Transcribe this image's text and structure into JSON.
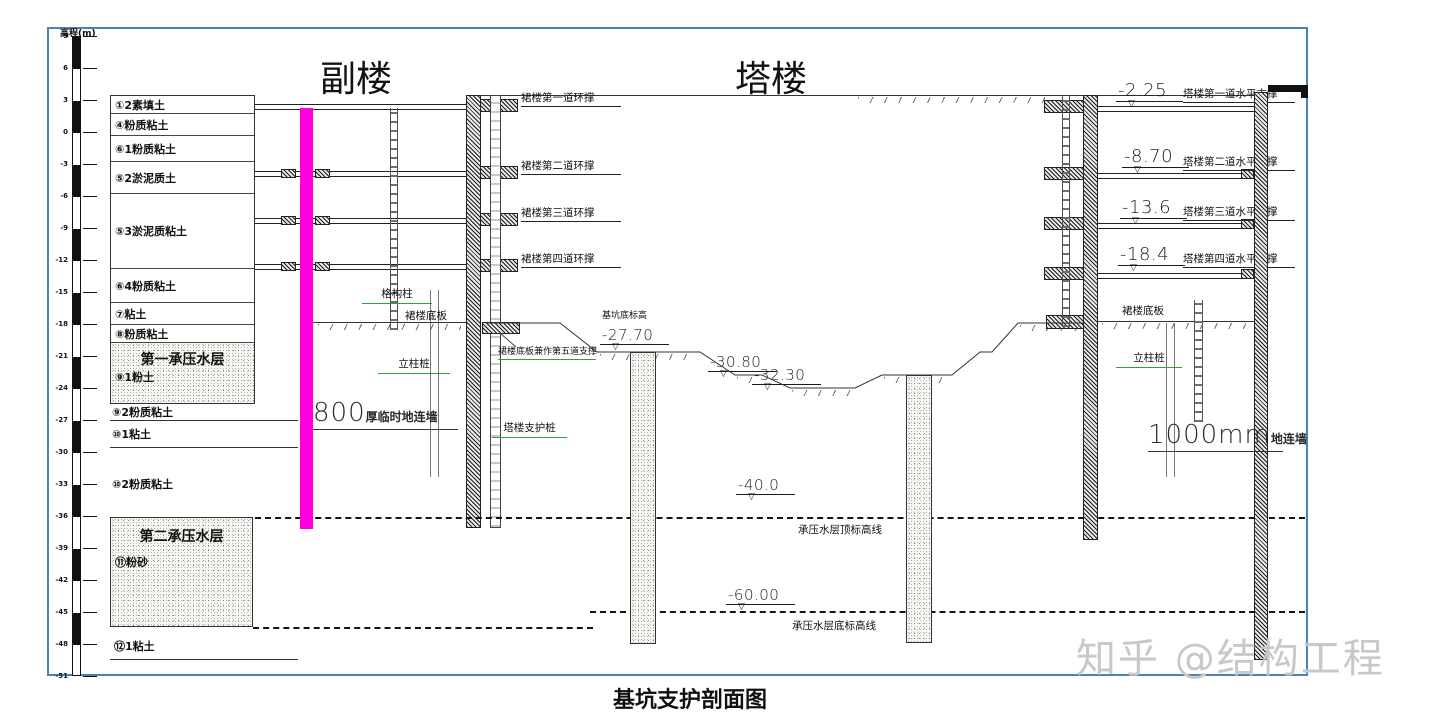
{
  "meta": {
    "title": "基坑支护剖面图",
    "watermark": "知乎 @结构工程"
  },
  "axis": {
    "label": "高程(m)",
    "ticks": [
      "9",
      "6",
      "3",
      "0",
      "-3",
      "-6",
      "-9",
      "-12",
      "-15",
      "-18",
      "-21",
      "-24",
      "-27",
      "-30",
      "-33",
      "-36",
      "-39",
      "-42",
      "-45",
      "-48",
      "-51"
    ]
  },
  "annex": {
    "title": "副楼",
    "struts": [
      "裙楼第一道环撑",
      "裙楼第二道环撑",
      "裙楼第三道环撑",
      "裙楼第四道环撑"
    ],
    "wall_num": "800",
    "wall_label": "厚临时地连墙"
  },
  "tower": {
    "title": "塔楼",
    "struts": [
      {
        "elev": "-2.25",
        "label": "塔楼第一道水平支撑"
      },
      {
        "elev": "-8.70",
        "label": "塔楼第二道水平支撑"
      },
      {
        "elev": "-13.6",
        "label": "塔楼第三道水平支撑"
      },
      {
        "elev": "-18.4",
        "label": "塔楼第四道水平支撑"
      }
    ],
    "wall_num": "1000mm",
    "wall_label": "地连墙"
  },
  "soil": {
    "rows": [
      {
        "label": "①2素填土",
        "h": 18
      },
      {
        "label": "④粉质粘土",
        "h": 22
      },
      {
        "label": "⑥1粉质粘土",
        "h": 26
      },
      {
        "label": "⑤2淤泥质土",
        "h": 32
      },
      {
        "label": "⑤3淤泥质粘土",
        "h": 75
      },
      {
        "label": "⑥4粉质粘土",
        "h": 34
      },
      {
        "label": "⑦粘土",
        "h": 22
      },
      {
        "label": "⑧粉质粘土",
        "h": 18
      },
      {
        "label": "⑨1粉土",
        "h": 60,
        "hatched": true,
        "aquifer": "第一承压水层"
      }
    ],
    "lower": [
      "⑨2粉质粘土",
      "⑩1粘土",
      "⑩2粉质粘土"
    ],
    "aquifer2": {
      "name": "第二承压水层",
      "soil": "⑪粉砂"
    },
    "bottom": "⑫1粘土"
  },
  "pit": {
    "floor_label": "基坑底标高",
    "elev_main": "-27.70",
    "elev_mid": "-30.80",
    "elev_deep": "-32.30"
  },
  "aquifer_lines": {
    "top_elev": "-40.0",
    "top_label": "承压水层顶标高线",
    "bottom_elev": "-60.00",
    "bottom_label": "承压水层底标高线"
  },
  "callouts": {
    "lattice_column": "格构柱",
    "podium_slab": "裙楼底板",
    "column_pile": "立柱桩",
    "slab_as_strut": "裙楼底板兼作第五道支撑",
    "tower_support_pile": "塔楼支护桩",
    "podium_slab_right": "裙楼底板",
    "column_pile_right": "立柱桩"
  },
  "colors": {
    "frame_blue": "#4a82b8",
    "marker_magenta": "#ff00dd",
    "callout_green": "#2ea043"
  }
}
